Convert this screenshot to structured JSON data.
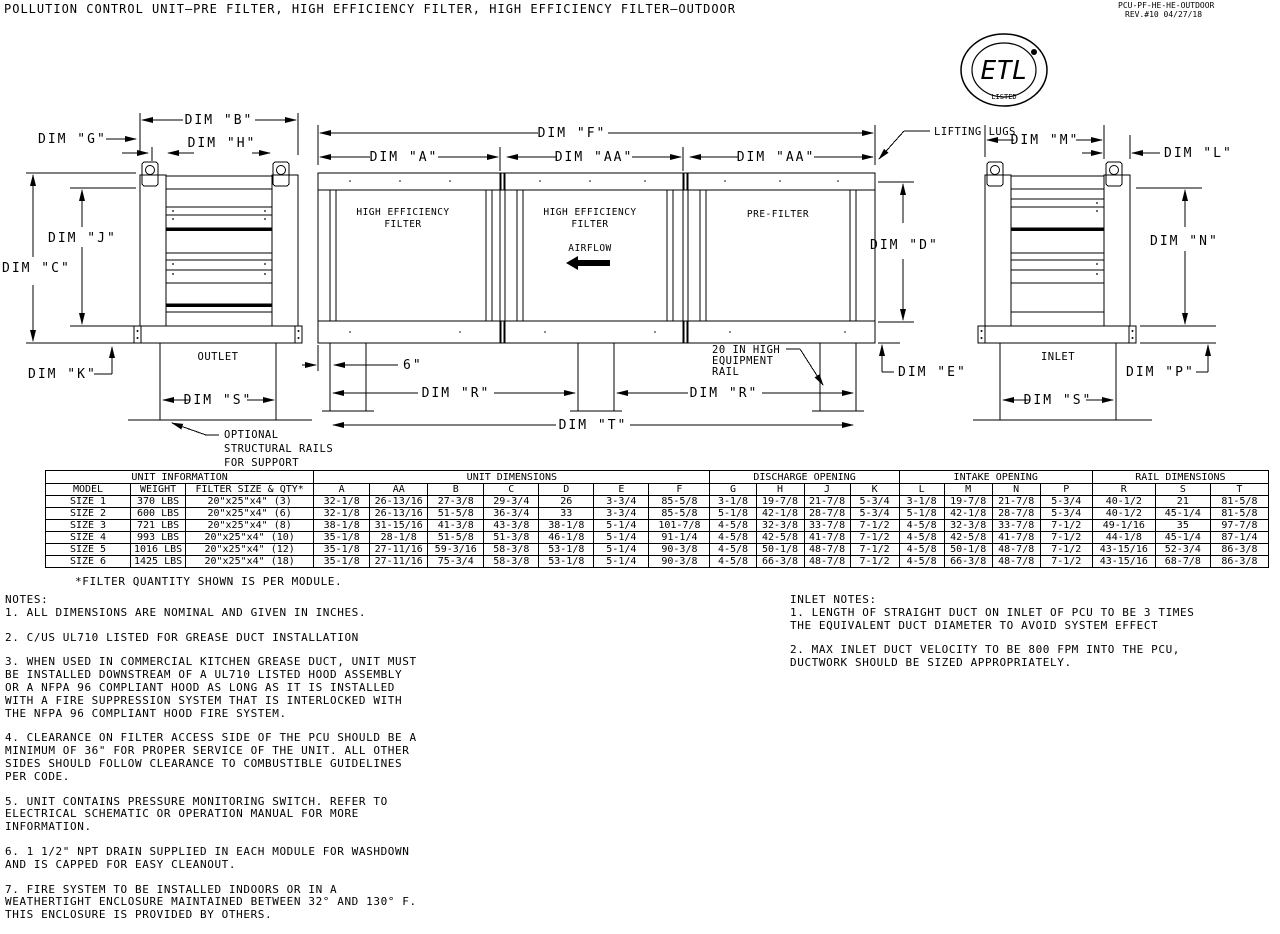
{
  "meta": {
    "title": "POLLUTION CONTROL UNIT–PRE FILTER, HIGH EFFICIENCY FILTER, HIGH EFFICIENCY FILTER–OUTDOOR",
    "doc_number": "PCU-PF-HE-HE-OUTDOOR",
    "revision": "REV.#10  04/27/18"
  },
  "logo": {
    "name": "ETL",
    "listed": "LISTED",
    "reg": "®"
  },
  "drawing": {
    "labels": {
      "dim_a": "DIM \"A\"",
      "dim_aa": "DIM \"AA\"",
      "dim_b": "DIM \"B\"",
      "dim_c": "DIM \"C\"",
      "dim_d": "DIM \"D\"",
      "dim_e": "DIM \"E\"",
      "dim_f": "DIM \"F\"",
      "dim_g": "DIM \"G\"",
      "dim_h": "DIM \"H\"",
      "dim_j": "DIM \"J\"",
      "dim_k": "DIM \"K\"",
      "dim_l": "DIM \"L\"",
      "dim_m": "DIM \"M\"",
      "dim_n": "DIM \"N\"",
      "dim_p": "DIM \"P\"",
      "dim_r": "DIM \"R\"",
      "dim_s": "DIM \"S\"",
      "dim_t": "DIM \"T\"",
      "six_inch": "6\"",
      "he1": "HIGH EFFICIENCY",
      "he2": "FILTER",
      "pre_filter": "PRE-FILTER",
      "airflow": "AIRFLOW",
      "lifting_lugs": "LIFTING LUGS",
      "rail1": "20 IN HIGH",
      "rail2": "EQUIPMENT",
      "rail3": "RAIL",
      "outlet": "OUTLET",
      "inlet": "INLET",
      "opt1": "OPTIONAL",
      "opt2": "STRUCTURAL RAILS",
      "opt3": "FOR SUPPORT"
    }
  },
  "table": {
    "groups": [
      {
        "label": "UNIT INFORMATION",
        "span": 3
      },
      {
        "label": "UNIT DIMENSIONS",
        "span": 7
      },
      {
        "label": "DISCHARGE OPENING",
        "span": 4
      },
      {
        "label": "INTAKE OPENING",
        "span": 4
      },
      {
        "label": "RAIL DIMENSIONS",
        "span": 3
      }
    ],
    "columns": [
      "MODEL",
      "WEIGHT",
      "FILTER SIZE & QTY*",
      "A",
      "AA",
      "B",
      "C",
      "D",
      "E",
      "F",
      "G",
      "H",
      "J",
      "K",
      "L",
      "M",
      "N",
      "P",
      "R",
      "S",
      "T"
    ],
    "rows": [
      [
        "SIZE 1",
        "370 LBS",
        "20\"x25\"x4\" (3)",
        "32-1/8",
        "26-13/16",
        "27-3/8",
        "29-3/4",
        "26",
        "3-3/4",
        "85-5/8",
        "3-1/8",
        "19-7/8",
        "21-7/8",
        "5-3/4",
        "3-1/8",
        "19-7/8",
        "21-7/8",
        "5-3/4",
        "40-1/2",
        "21",
        "81-5/8"
      ],
      [
        "SIZE 2",
        "600 LBS",
        "20\"x25\"x4\" (6)",
        "32-1/8",
        "26-13/16",
        "51-5/8",
        "36-3/4",
        "33",
        "3-3/4",
        "85-5/8",
        "5-1/8",
        "42-1/8",
        "28-7/8",
        "5-3/4",
        "5-1/8",
        "42-1/8",
        "28-7/8",
        "5-3/4",
        "40-1/2",
        "45-1/4",
        "81-5/8"
      ],
      [
        "SIZE 3",
        "721 LBS",
        "20\"x25\"x4\" (8)",
        "38-1/8",
        "31-15/16",
        "41-3/8",
        "43-3/8",
        "38-1/8",
        "5-1/4",
        "101-7/8",
        "4-5/8",
        "32-3/8",
        "33-7/8",
        "7-1/2",
        "4-5/8",
        "32-3/8",
        "33-7/8",
        "7-1/2",
        "49-1/16",
        "35",
        "97-7/8"
      ],
      [
        "SIZE 4",
        "993 LBS",
        "20\"x25\"x4\" (10)",
        "35-1/8",
        "28-1/8",
        "51-5/8",
        "51-3/8",
        "46-1/8",
        "5-1/4",
        "91-1/4",
        "4-5/8",
        "42-5/8",
        "41-7/8",
        "7-1/2",
        "4-5/8",
        "42-5/8",
        "41-7/8",
        "7-1/2",
        "44-1/8",
        "45-1/4",
        "87-1/4"
      ],
      [
        "SIZE 5",
        "1016 LBS",
        "20\"x25\"x4\" (12)",
        "35-1/8",
        "27-11/16",
        "59-3/16",
        "58-3/8",
        "53-1/8",
        "5-1/4",
        "90-3/8",
        "4-5/8",
        "50-1/8",
        "48-7/8",
        "7-1/2",
        "4-5/8",
        "50-1/8",
        "48-7/8",
        "7-1/2",
        "43-15/16",
        "52-3/4",
        "86-3/8"
      ],
      [
        "SIZE 6",
        "1425 LBS",
        "20\"x25\"x4\" (18)",
        "35-1/8",
        "27-11/16",
        "75-3/4",
        "58-3/8",
        "53-1/8",
        "5-1/4",
        "90-3/8",
        "4-5/8",
        "66-3/8",
        "48-7/8",
        "7-1/2",
        "4-5/8",
        "66-3/8",
        "48-7/8",
        "7-1/2",
        "43-15/16",
        "68-7/8",
        "86-3/8"
      ]
    ],
    "footnote": "*FILTER QUANTITY SHOWN IS PER MODULE."
  },
  "notes": {
    "title": "NOTES:",
    "items": [
      "1. ALL DIMENSIONS ARE NOMINAL AND GIVEN IN INCHES.",
      "2. C/US UL710 LISTED FOR GREASE DUCT INSTALLATION",
      "3. WHEN USED IN COMMERCIAL KITCHEN GREASE DUCT, UNIT MUST\nBE INSTALLED DOWNSTREAM OF A UL710 LISTED HOOD ASSEMBLY\nOR A NFPA 96 COMPLIANT HOOD AS LONG AS IT IS INSTALLED\nWITH A FIRE SUPPRESSION SYSTEM THAT IS INTERLOCKED WITH\nTHE NFPA 96 COMPLIANT HOOD FIRE SYSTEM.",
      "4. CLEARANCE ON FILTER ACCESS SIDE OF THE PCU SHOULD BE A\nMINIMUM OF 36\" FOR PROPER SERVICE OF THE UNIT. ALL OTHER\nSIDES SHOULD FOLLOW CLEARANCE TO COMBUSTIBLE GUIDELINES\nPER CODE.",
      "5. UNIT CONTAINS PRESSURE MONITORING SWITCH. REFER TO\nELECTRICAL SCHEMATIC OR OPERATION MANUAL FOR MORE\nINFORMATION.",
      "6. 1 1/2\" NPT DRAIN SUPPLIED IN EACH MODULE FOR WASHDOWN\nAND IS CAPPED FOR EASY CLEANOUT.",
      "7. FIRE SYSTEM TO BE INSTALLED INDOORS OR IN A\nWEATHERTIGHT ENCLOSURE MAINTAINED BETWEEN 32° AND 130° F.\nTHIS ENCLOSURE IS PROVIDED BY OTHERS."
    ]
  },
  "inlet_notes": {
    "title": "INLET NOTES:",
    "items": [
      "1. LENGTH OF STRAIGHT DUCT ON INLET OF PCU TO BE 3 TIMES\nTHE EQUIVALENT DUCT DIAMETER TO AVOID SYSTEM EFFECT",
      "2. MAX INLET DUCT VELOCITY TO BE 800 FPM INTO THE PCU,\nDUCTWORK SHOULD BE SIZED APPROPRIATELY."
    ]
  }
}
